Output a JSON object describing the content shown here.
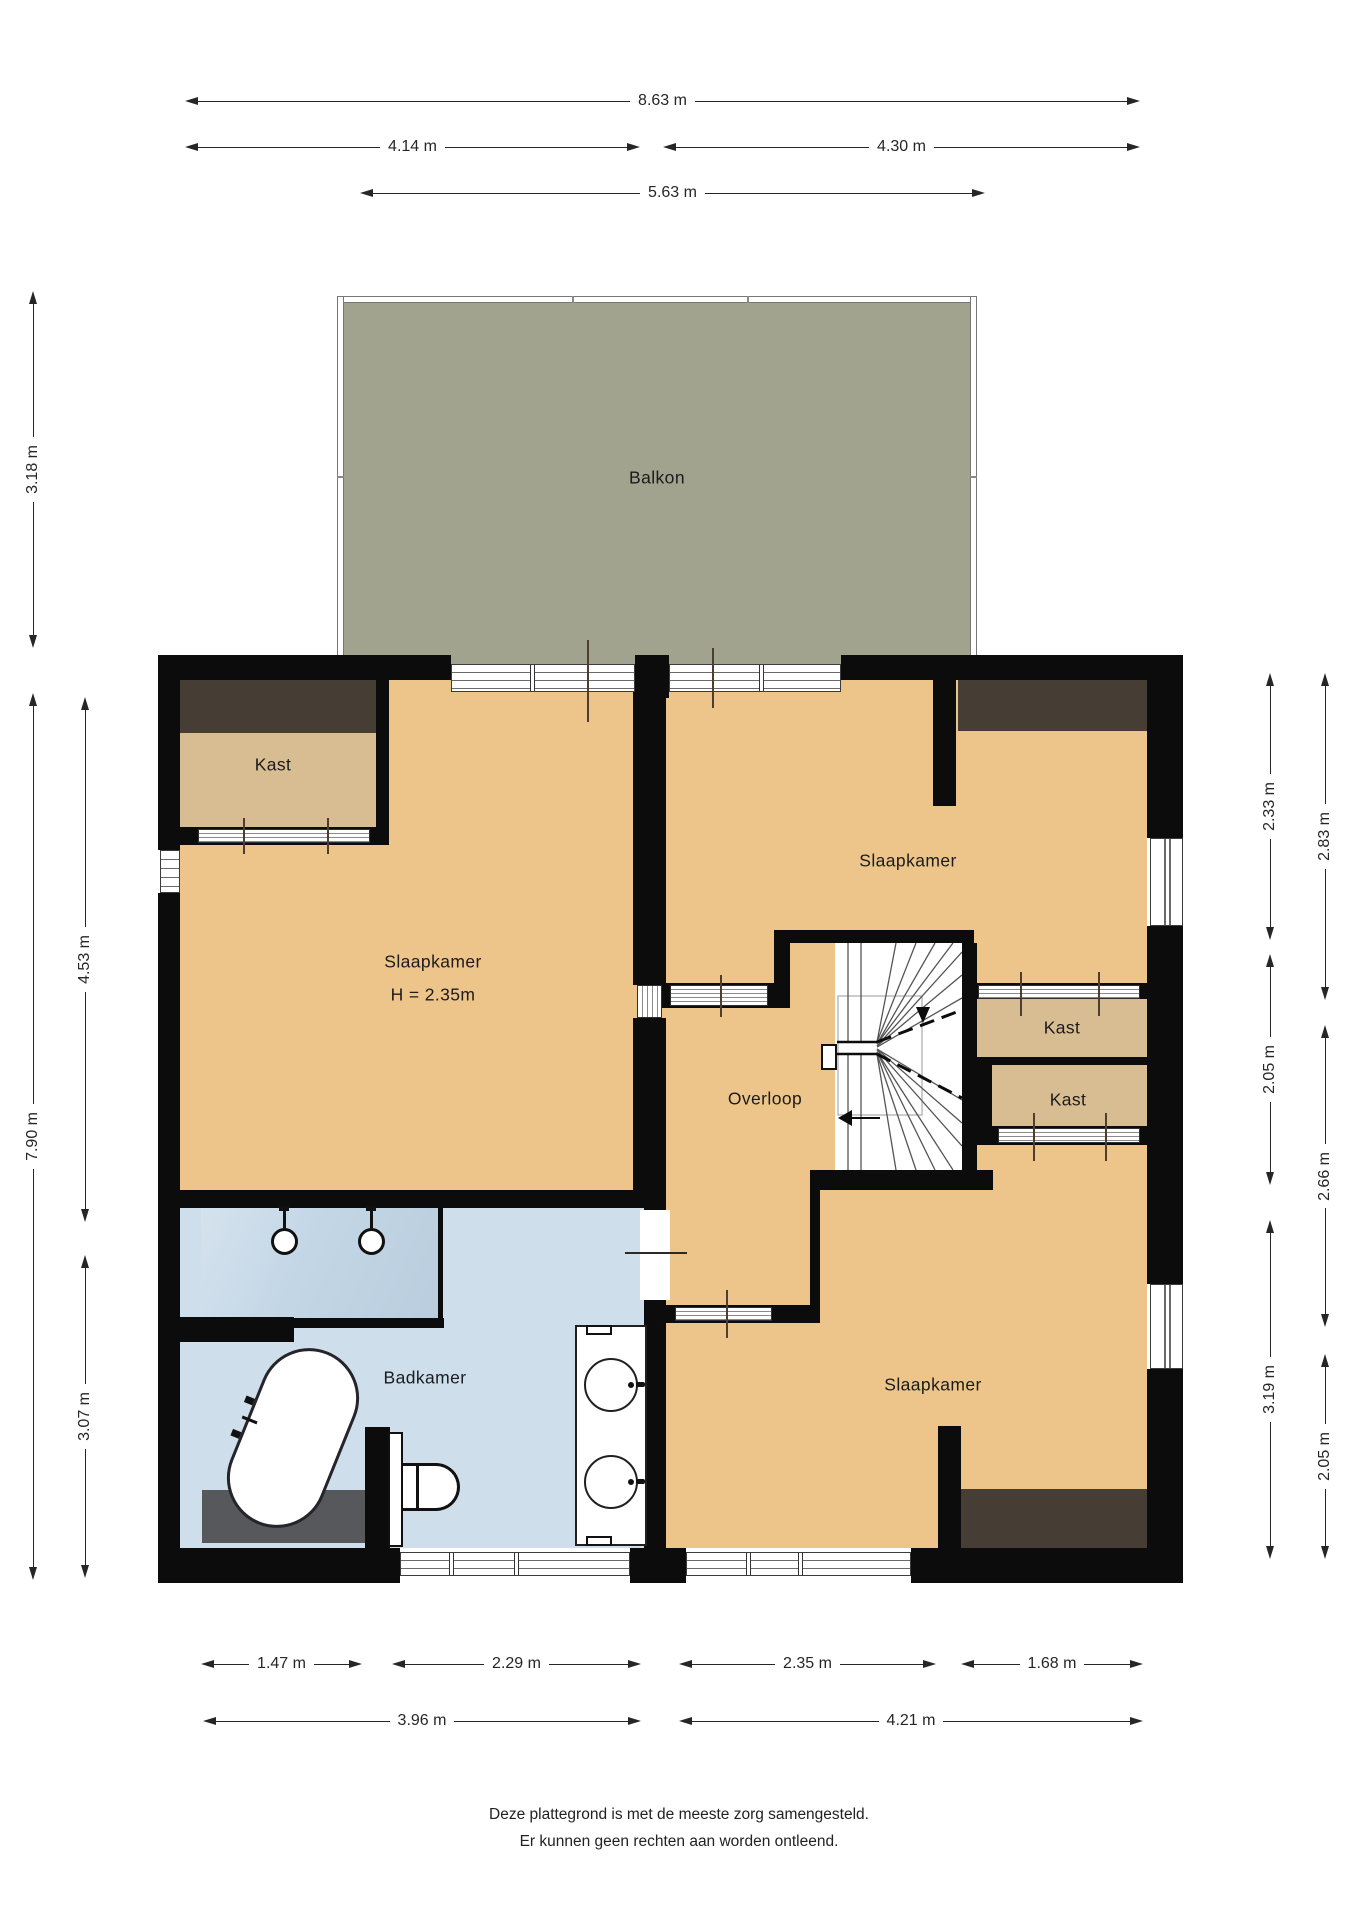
{
  "rooms": {
    "balkon": "Balkon",
    "kast_tl": "Kast",
    "slaapkamer_l": "Slaapkamer",
    "slaapkamer_l_h": "H = 2.35m",
    "slaapkamer_tr": "Slaapkamer",
    "overloop": "Overloop",
    "kast_r1": "Kast",
    "kast_r2": "Kast",
    "badkamer": "Badkamer",
    "slaapkamer_br": "Slaapkamer"
  },
  "dims": {
    "t863": "8.63 m",
    "t414": "4.14 m",
    "t430": "4.30 m",
    "t563": "5.63 m",
    "l318": "3.18 m",
    "l790": "7.90 m",
    "l453": "4.53 m",
    "l307": "3.07 m",
    "r233": "2.33 m",
    "r205a": "2.05 m",
    "r319": "3.19 m",
    "r283": "2.83 m",
    "r266": "2.66 m",
    "r205b": "2.05 m",
    "b147": "1.47 m",
    "b229": "2.29 m",
    "b235": "2.35 m",
    "b168": "1.68 m",
    "b396": "3.96 m",
    "b421": "4.21 m"
  },
  "footer": {
    "line1": "Deze plattegrond is met de meeste zorg samengesteld.",
    "line2": "Er kunnen geen rechten aan worden ontleend."
  },
  "colors": {
    "wall": "#0c0c0c",
    "floor": "#edc58b",
    "closet_floor": "#d9bd92",
    "balcony": "#a2a38f",
    "bathroom": "#cfdeeb",
    "shower": "#c3d6e6",
    "wardrobe": "#463e34",
    "mat": "#56585c",
    "dim": "#262626",
    "text": "#1b1b1b"
  }
}
